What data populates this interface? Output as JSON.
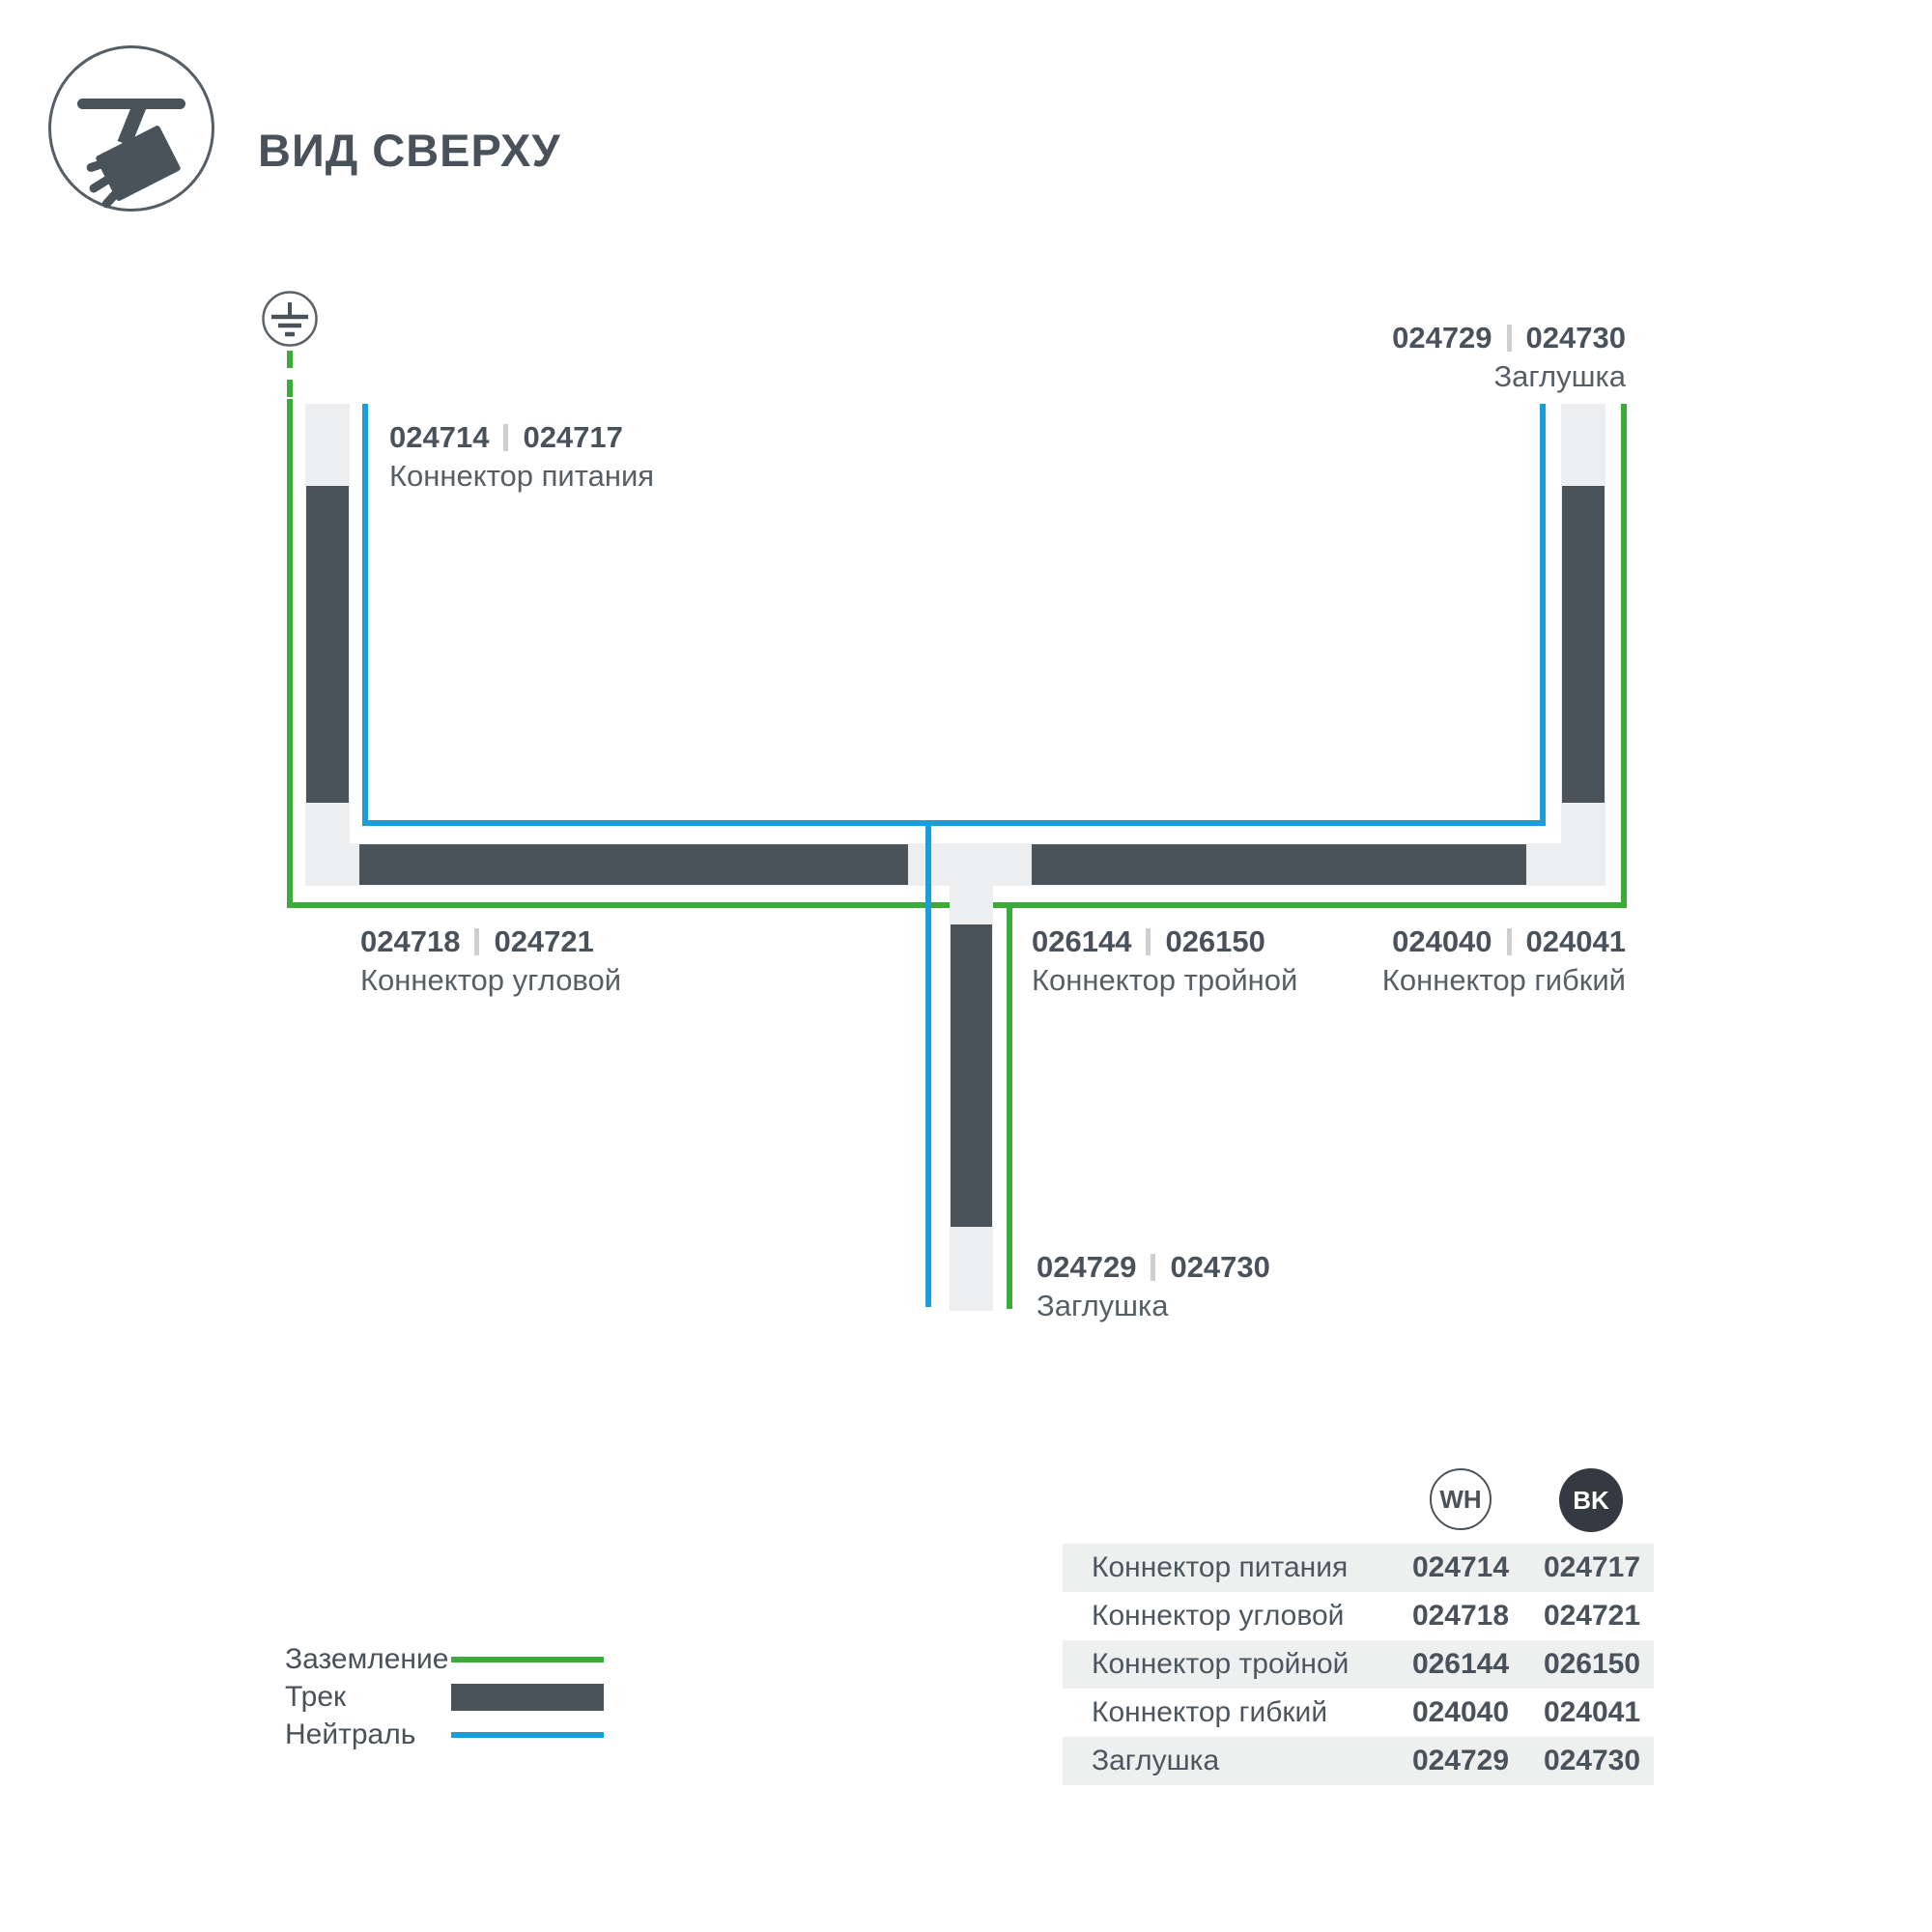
{
  "header": {
    "title": "ВИД СВЕРХУ"
  },
  "diagram": {
    "labels": {
      "power": {
        "num_wh": "024714",
        "num_bk": "024717",
        "name": "Коннектор питания"
      },
      "cap_top": {
        "num_wh": "024729",
        "num_bk": "024730",
        "name": "Заглушка"
      },
      "corner": {
        "num_wh": "024718",
        "num_bk": "024721",
        "name": "Коннектор угловой"
      },
      "triple": {
        "num_wh": "026144",
        "num_bk": "026150",
        "name": "Коннектор тройной"
      },
      "flexible": {
        "num_wh": "024040",
        "num_bk": "024041",
        "name": "Коннектор гибкий"
      },
      "cap_bottom": {
        "num_wh": "024729",
        "num_bk": "024730",
        "name": "Заглушка"
      }
    },
    "colors": {
      "ground_wire": "#3cac39",
      "neutral_wire": "#1b9dd9",
      "track_dark": "#4a525a",
      "track_light": "#eceeef"
    }
  },
  "legend": {
    "items": [
      {
        "label": "Заземление",
        "type": "ground"
      },
      {
        "label": "Трек",
        "type": "track"
      },
      {
        "label": "Нейтраль",
        "type": "neutral"
      }
    ]
  },
  "table": {
    "col_wh": "WH",
    "col_bk": "BK",
    "rows": [
      {
        "name": "Коннектор питания",
        "wh": "024714",
        "bk": "024717"
      },
      {
        "name": "Коннектор угловой",
        "wh": "024718",
        "bk": "024721"
      },
      {
        "name": "Коннектор тройной",
        "wh": "026144",
        "bk": "026150"
      },
      {
        "name": "Коннектор гибкий",
        "wh": "024040",
        "bk": "024041"
      },
      {
        "name": "Заглушка",
        "wh": "024729",
        "bk": "024730"
      }
    ]
  }
}
